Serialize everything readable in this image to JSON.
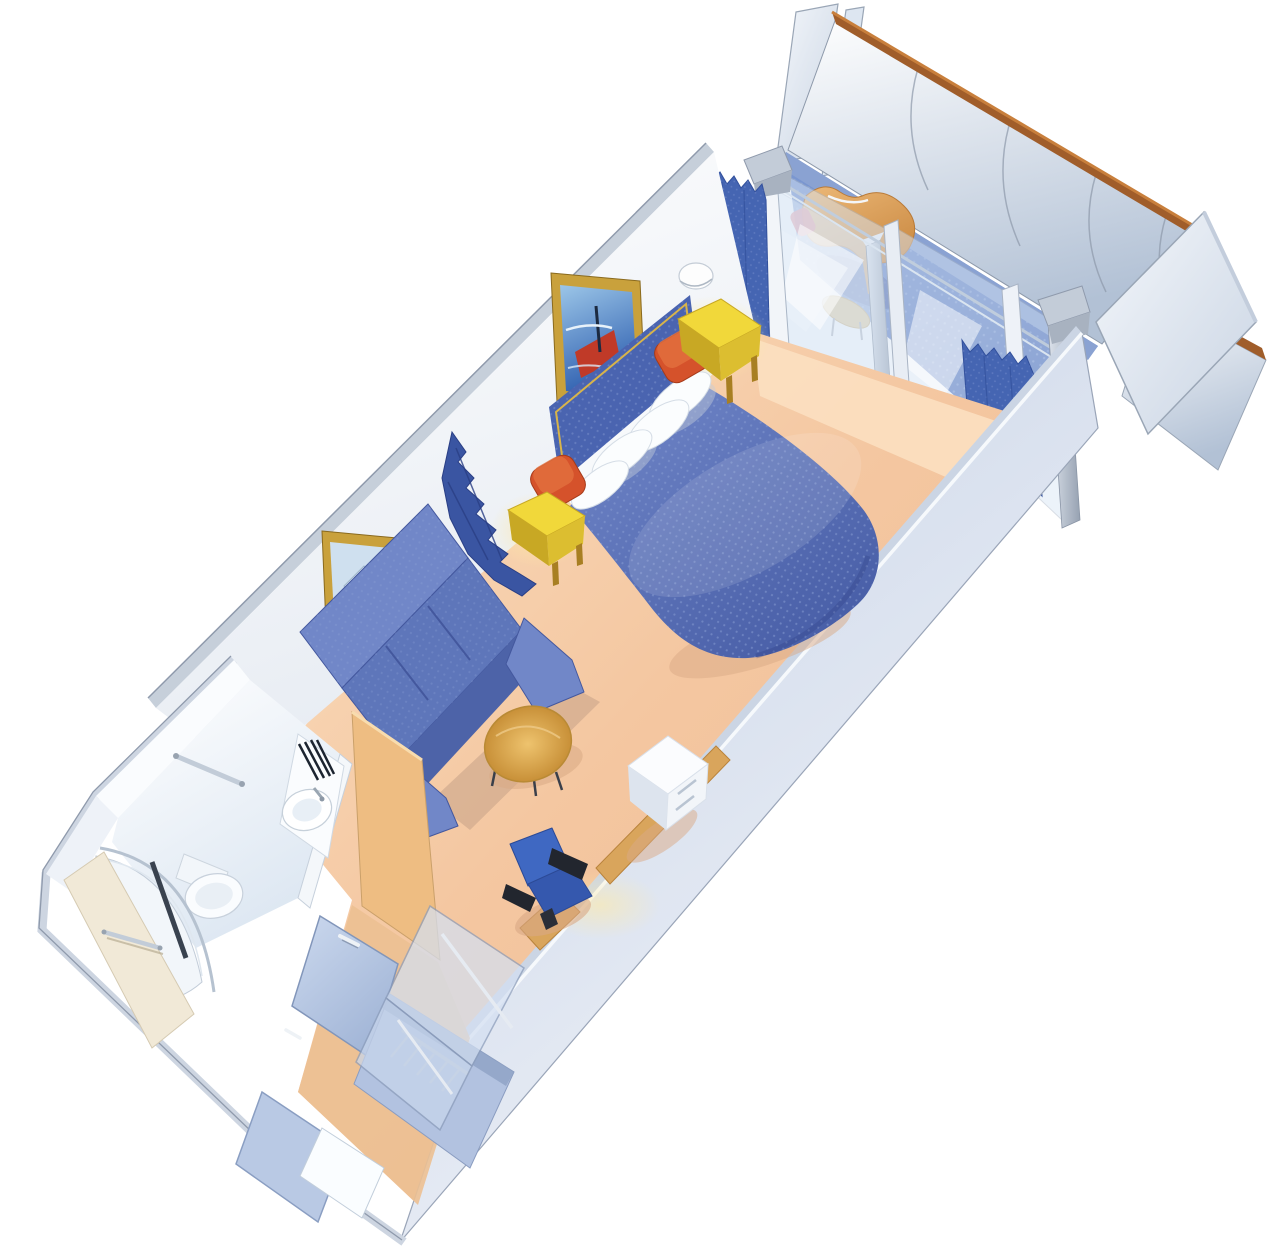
{
  "scene": {
    "description": "3D isometric cutaway illustration of a cruise-ship balcony stateroom floor plan, rotated diagonally on a white background",
    "background": "#ffffff"
  },
  "palette": {
    "carpet_peach": "#f4c7a1",
    "carpet_light": "#fbe2c6",
    "balcony_floor": "#5f7fc4",
    "bed_spread": "#5b74b6",
    "bed_spread_dark": "#41559e",
    "headboard_blue": "#4a64b0",
    "gold_trim": "#c9a13c",
    "pillow_white": "#fbfdfe",
    "cushion_orange": "#d5522b",
    "nightstand_yellow": "#f1d83a",
    "nightstand_yellow_side": "#c8a824",
    "sofa_blue": "#7187c8",
    "sofa_blue_dark": "#5e76ba",
    "table_wood": "#dfae55",
    "desk_wood": "#d9a55c",
    "chair_blue": "#3f68c2",
    "chair_arm_black": "#22262e",
    "cabinet_white": "#fbfcfe",
    "wall_white": "#ffffff",
    "wall_cap_gray": "#c6cfda",
    "wall_edge_gray": "#8f9aac",
    "right_wall_blue": "#ccd6e8",
    "glass_blue": "#d7e5f5",
    "glass_frame": "#aab6c6",
    "curtain_blue": "#4565b2",
    "railing_wood": "#a05d2a",
    "railing_panel": "#dde7f1",
    "cream_wall": "#f1e9d7",
    "door_panel": "#b9c9e4",
    "chrome": "#c2ccd8",
    "closet_interior": "#b2c2e0",
    "wardrobe_wood": "#eebd82",
    "fixture_white": "#fafcfe",
    "shadow_warm": "#d9a985",
    "shadow_blue": "#33478e",
    "art_sea_blue": "#2b5cae",
    "art_ship_red": "#c03a28"
  },
  "rooms": {
    "balcony": {
      "floor": "#5f7fc4",
      "items": [
        "deck-lounge-chair",
        "side-table",
        "glass-balustrade",
        "privacy-partition-left",
        "privacy-partition-right",
        "railing-wood-cap"
      ]
    },
    "bedroom": {
      "floor": "#f4c7a1",
      "items": [
        "double-bed",
        "pillows-x4",
        "accent-cushions-x2",
        "headboard-panel",
        "wall-art-x2",
        "wall-sconce",
        "nightstands-x2",
        "sofa-3-seat",
        "coffee-table",
        "desk",
        "tv-cabinet",
        "desk-chair",
        "curtains",
        "sliding-glass-door"
      ]
    },
    "bathroom": {
      "floor": "#eef3f9",
      "items": [
        "vanity-sink",
        "faucet",
        "accessory-rack",
        "grab-bar",
        "toilet",
        "curved-shower",
        "towel-bar"
      ]
    },
    "entry": {
      "floor": "#ecc092",
      "items": [
        "cabin-door",
        "closet-with-hangers",
        "wardrobe-glass-doors",
        "mirror"
      ]
    }
  },
  "counts": {
    "pillows": 4,
    "accent_cushions": 2,
    "hangers": 5,
    "railing_seams": 4,
    "sofa_seats": 3
  }
}
